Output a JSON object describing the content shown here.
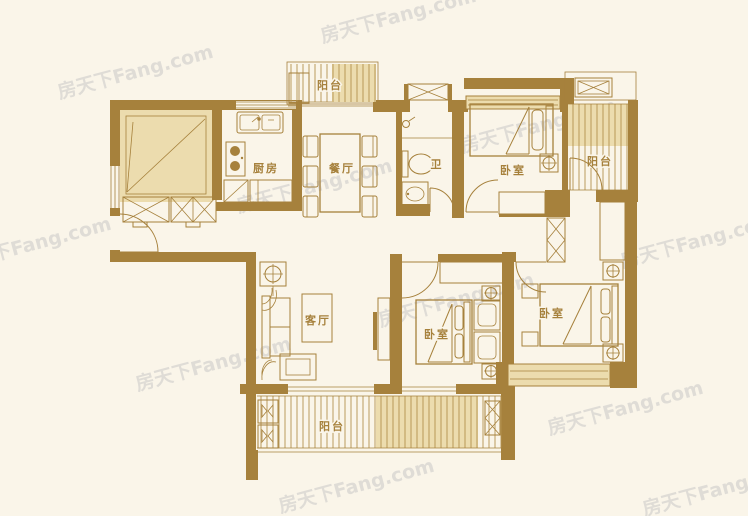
{
  "watermark": {
    "text": "房天下Fang.com"
  },
  "colors": {
    "wall": "#a6813c",
    "room_fill": "#ecdcae",
    "background": "#faf5e9",
    "watermark": "#c5c5c5"
  },
  "rooms": {
    "kitchen": {
      "label": "厨房"
    },
    "dining": {
      "label": "餐厅"
    },
    "bath": {
      "label": "卫"
    },
    "living": {
      "label": "客厅"
    },
    "bedroom_north": {
      "label": "卧室"
    },
    "bedroom_middle": {
      "label": "卧室"
    },
    "bedroom_master": {
      "label": "卧室"
    },
    "balcony_north": {
      "label": "阳台"
    },
    "balcony_east": {
      "label": "阳台"
    },
    "balcony_south": {
      "label": "阳台"
    }
  }
}
